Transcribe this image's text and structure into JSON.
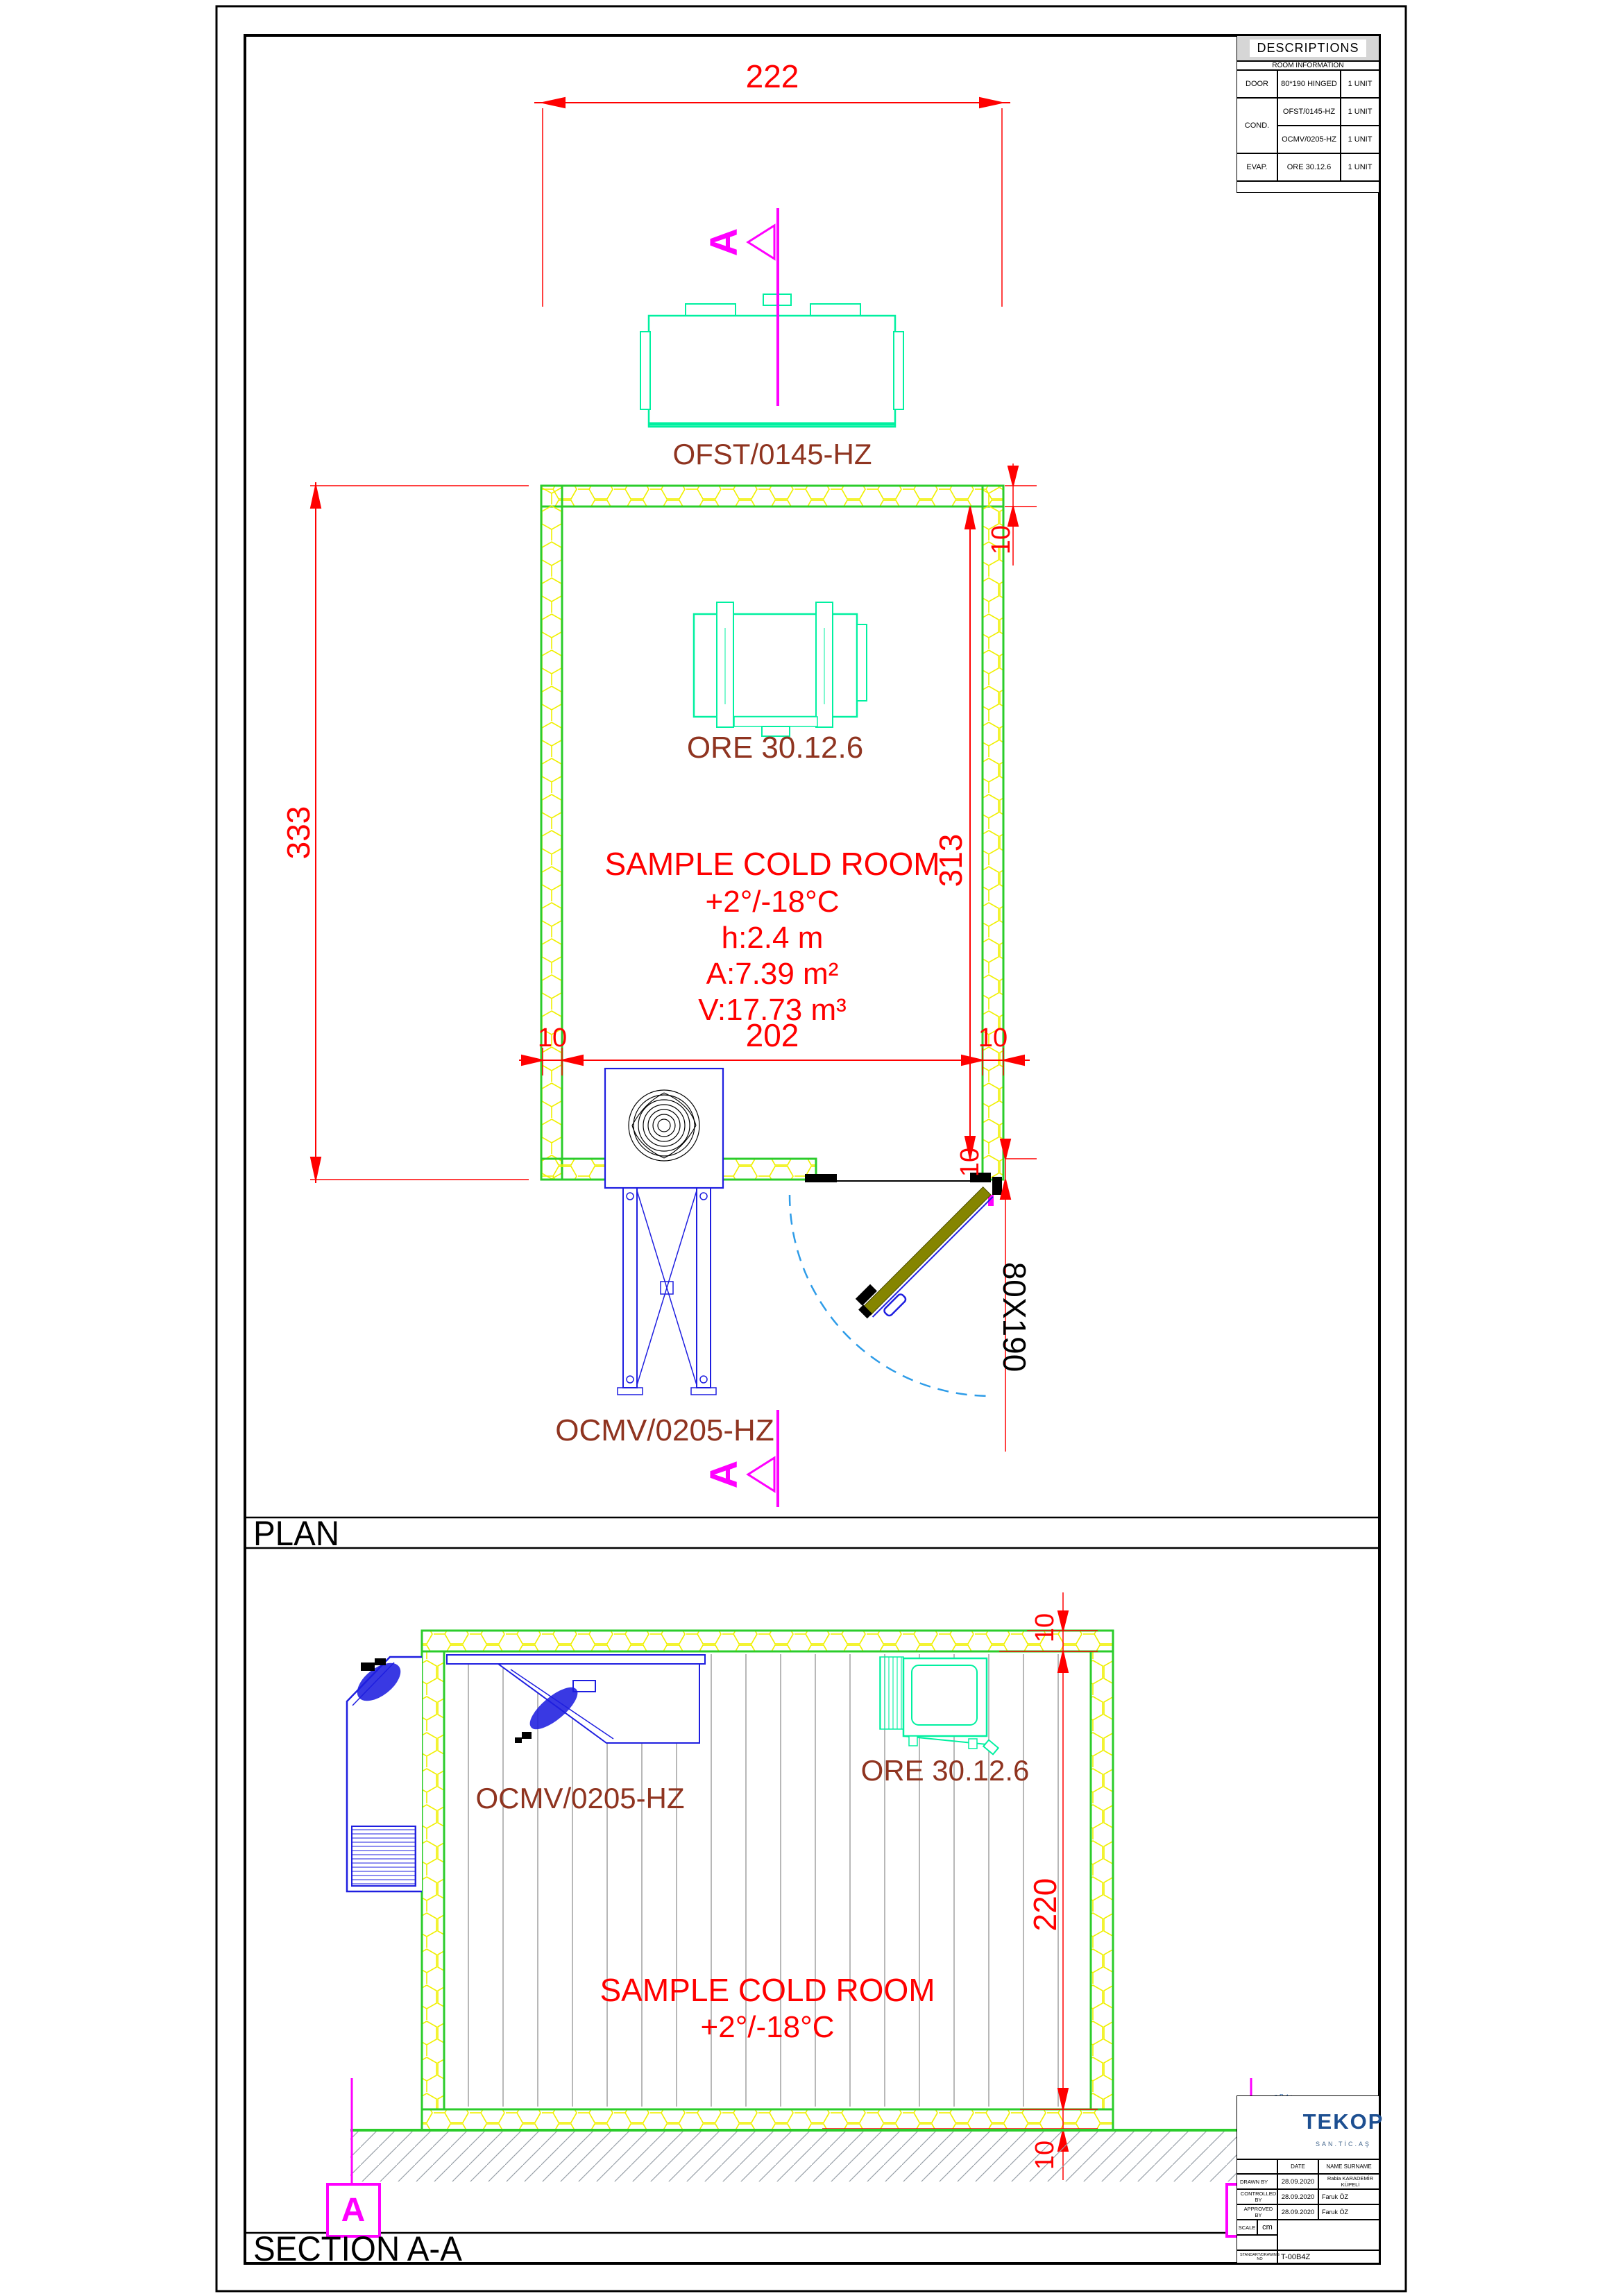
{
  "frame": {
    "plan_title": "PLAN",
    "section_title": "SECTION A-A"
  },
  "descriptions": {
    "title": "DESCRIPTIONS",
    "subtitle": "ROOM INFORMATION",
    "rows": [
      {
        "cat": "DOOR",
        "desc": "80*190 HINGED",
        "qty": "1 UNIT"
      },
      {
        "cat": "COND.",
        "desc": "OFST/0145-HZ",
        "qty": "1 UNIT"
      },
      {
        "desc": "OCMV/0205-HZ",
        "qty": "1 UNIT"
      },
      {
        "cat": "EVAP.",
        "desc": "ORE 30.12.6",
        "qty": "1 UNIT"
      }
    ]
  },
  "plan": {
    "dim_width": "222",
    "dim_depth": "333",
    "dim_inner_depth": "313",
    "dim_left_wall": "10",
    "dim_inner_width": "202",
    "dim_right_wall": "10",
    "dim_top_wall": "10",
    "dim_door_wall": "10",
    "door_size": "80X190",
    "condenser_label": "OFST/0145-HZ",
    "evaporator_label": "ORE 30.12.6",
    "monoblock_label": "OCMV/0205-HZ",
    "room_lines": [
      "SAMPLE COLD ROOM",
      "+2°/-18°C",
      "h:2.4 m",
      "A:7.39 m²",
      "V:17.73 m³"
    ],
    "marker": "A"
  },
  "section": {
    "dim_ceiling": "10",
    "dim_height": "220",
    "dim_floor": "10",
    "monoblock_label": "OCMV/0205-HZ",
    "evaporator_label": "ORE 30.12.6",
    "room_lines": [
      "SAMPLE COLD ROOM",
      "+2°/-18°C"
    ],
    "marker_left": "A",
    "marker_right": "A"
  },
  "title_block": {
    "brand": "TEKOP",
    "brand_sub": "SAN.TİC.AŞ",
    "brand_arc": "REFRIGERATION",
    "col_date": "DATE",
    "col_name": "NAME SURNAME",
    "rows": [
      {
        "label": "DRAWN BY",
        "date": "28.09.2020",
        "name": "Rabia KARADEMİR KÜPELİ"
      },
      {
        "label": "CONTROLLED BY",
        "date": "28.09.2020",
        "name": "Faruk ÖZ"
      },
      {
        "label": "APPROVED BY",
        "date": "28.09.2020",
        "name": "Faruk ÖZ"
      }
    ],
    "scale_label": "SCALE",
    "scale_value": "cm",
    "drawing_no_label": "STANDART/DRAWING NO",
    "drawing_no": "T-00B4Z"
  },
  "colors": {
    "dim_red": "#ff0000",
    "label_brown": "#8f3420",
    "wall_green": "#2bcc2b",
    "insulation_yellow": "#f0f000",
    "equipment_green": "#00f0a0",
    "equipment_blue": "#1e1ee0",
    "marker_magenta": "#ff00ff",
    "door_olive": "#858500",
    "arc_blue": "#2e9ce8",
    "brand_blue": "#1d4f91"
  }
}
